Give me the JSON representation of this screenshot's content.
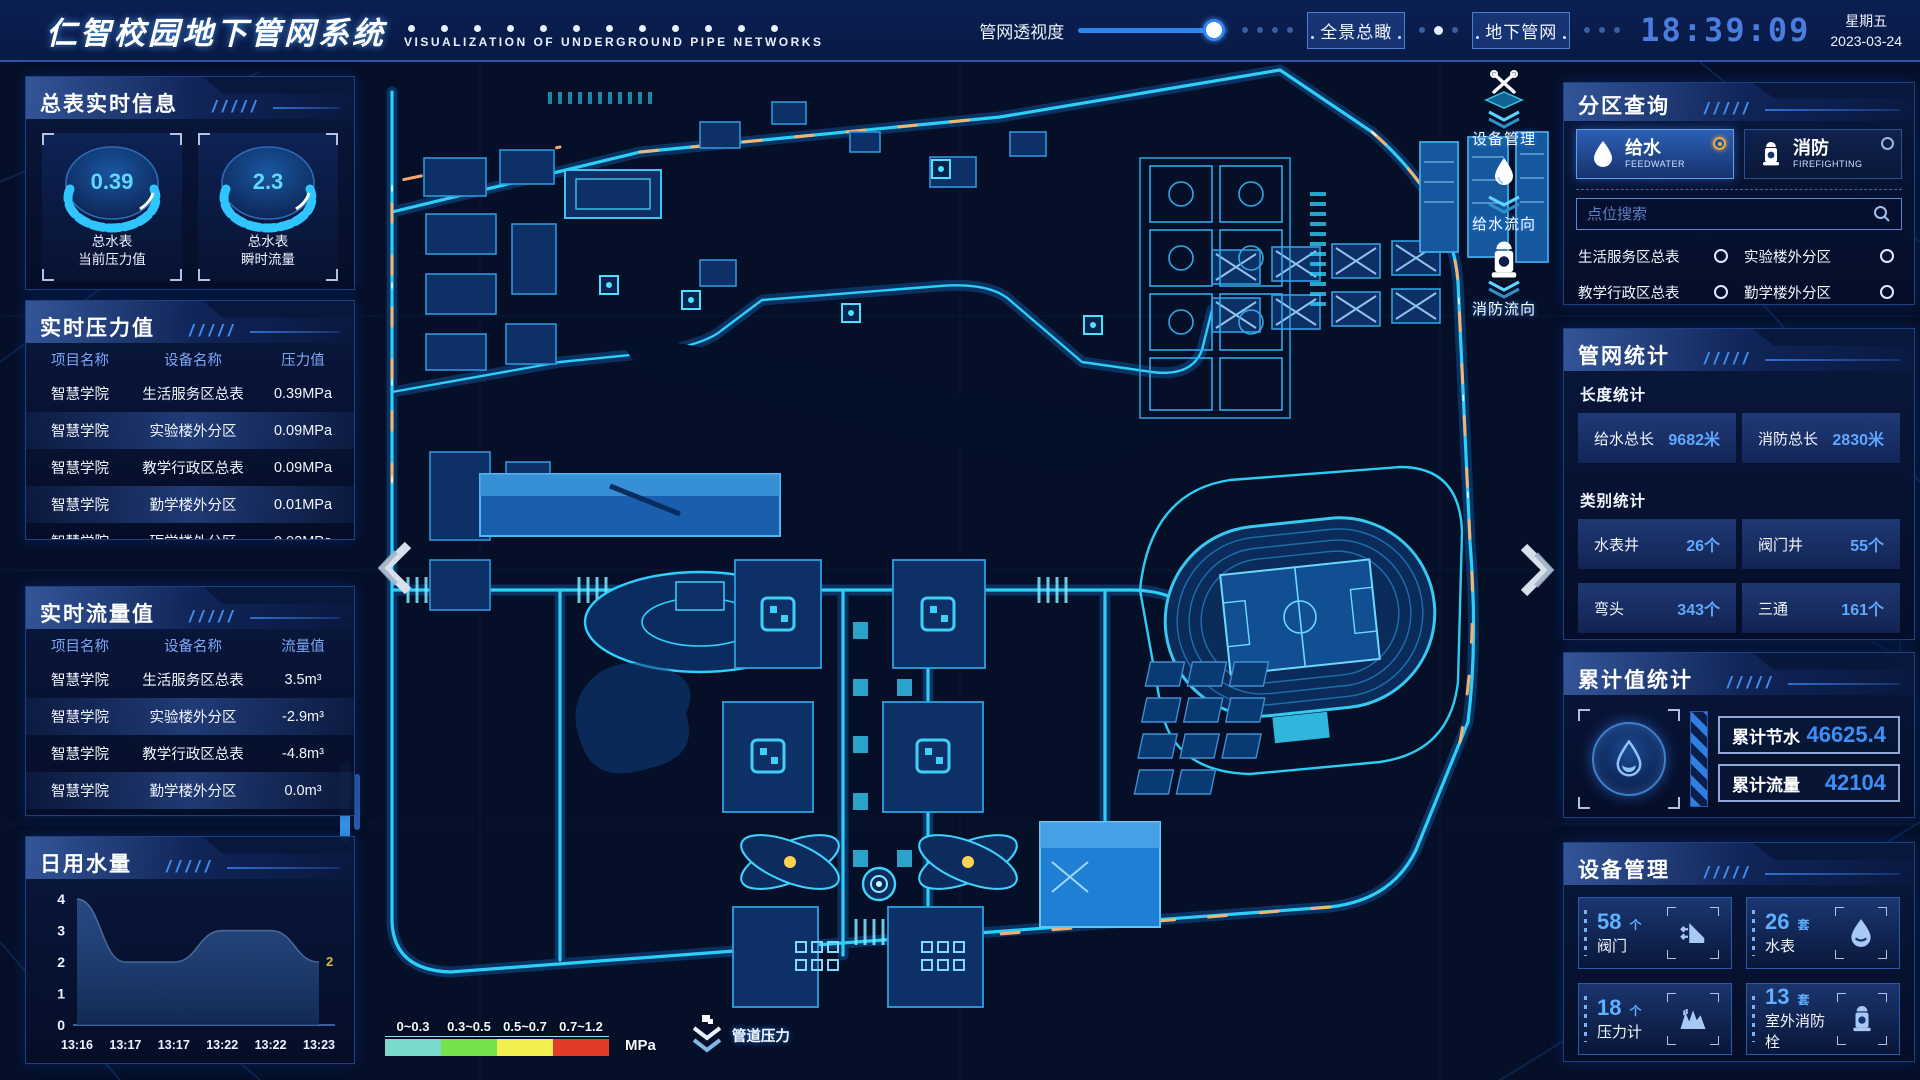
{
  "header": {
    "title": "仁智校园地下管网系统",
    "subtitle": "VISUALIZATION OF UNDERGROUND PIPE NETWORKS",
    "slider_label": "管网透视度",
    "btn_overview": "全景总瞰",
    "btn_underground": "地下管网",
    "time": "18:39:09",
    "weekday": "星期五",
    "date": "2023-03-24"
  },
  "left": {
    "meter": {
      "title": "总表实时信息",
      "gauges": [
        {
          "value": "0.39",
          "line1": "总水表",
          "line2": "当前压力值"
        },
        {
          "value": "2.3",
          "line1": "总水表",
          "line2": "瞬时流量"
        }
      ]
    },
    "pressure": {
      "title": "实时压力值",
      "headers": [
        "项目名称",
        "设备名称",
        "压力值"
      ],
      "rows": [
        [
          "智慧学院",
          "生活服务区总表",
          "0.39MPa"
        ],
        [
          "智慧学院",
          "实验楼外分区",
          "0.09MPa"
        ],
        [
          "智慧学院",
          "教学行政区总表",
          "0.09MPa"
        ],
        [
          "智慧学院",
          "勤学楼外分区",
          "0.01MPa"
        ],
        [
          "智慧学院",
          "砺学楼外分区",
          "0.02MPa"
        ]
      ]
    },
    "flow": {
      "title": "实时流量值",
      "headers": [
        "项目名称",
        "设备名称",
        "流量值"
      ],
      "rows": [
        [
          "智慧学院",
          "生活服务区总表",
          "3.5m³"
        ],
        [
          "智慧学院",
          "实验楼外分区",
          "-2.9m³"
        ],
        [
          "智慧学院",
          "教学行政区总表",
          "-4.8m³"
        ],
        [
          "智慧学院",
          "勤学楼外分区",
          "0.0m³"
        ],
        [
          "智慧学院",
          "砺学楼外分区",
          "2.3m³"
        ]
      ]
    },
    "daily": {
      "title": "日用水量"
    }
  },
  "chart_data": {
    "type": "area",
    "title": "日用水量",
    "x": [
      "13:16",
      "13:17",
      "13:17",
      "13:22",
      "13:22",
      "13:23"
    ],
    "values": [
      4,
      2,
      2,
      3,
      3,
      2
    ],
    "ylim": [
      0,
      4
    ],
    "yticks": [
      0,
      1,
      2,
      3,
      4
    ],
    "end_label": "2",
    "xlabel": "",
    "ylabel": "",
    "grid": false,
    "legend_position": "none"
  },
  "right": {
    "zone": {
      "title": "分区查询",
      "feedwater": {
        "label": "给水",
        "sub": "FEEDWATER",
        "selected": true
      },
      "fire": {
        "label": "消防",
        "sub": "FIREFIGHTING",
        "selected": false
      },
      "search_placeholder": "点位搜索",
      "zones": [
        "生活服务区总表",
        "实验楼外分区",
        "教学行政区总表",
        "勤学楼外分区",
        "砺学楼外分区",
        "宿舍区泵房"
      ]
    },
    "stats": {
      "title": "管网统计",
      "len_label": "长度统计",
      "cat_label": "类别统计",
      "length": [
        {
          "label": "给水总长",
          "value": "9682米"
        },
        {
          "label": "消防总长",
          "value": "2830米"
        }
      ],
      "categories": [
        {
          "label": "水表井",
          "value": "26个"
        },
        {
          "label": "阀门井",
          "value": "55个"
        },
        {
          "label": "弯头",
          "value": "343个"
        },
        {
          "label": "三通",
          "value": "161个"
        }
      ]
    },
    "cumulative": {
      "title": "累计值统计",
      "items": [
        {
          "label": "累计节水",
          "value": "46625.4"
        },
        {
          "label": "累计流量",
          "value": "42104"
        }
      ]
    },
    "devices": {
      "title": "设备管理",
      "items": [
        {
          "count": "58",
          "unit": "个",
          "label": "阀门",
          "icon": "valve-icon"
        },
        {
          "count": "26",
          "unit": "套",
          "label": "水表",
          "icon": "water-meter-icon"
        },
        {
          "count": "18",
          "unit": "个",
          "label": "压力计",
          "icon": "pressure-gauge-icon"
        },
        {
          "count": "13",
          "unit": "套",
          "label": "室外消防栓",
          "icon": "hydrant-icon"
        }
      ]
    }
  },
  "map": {
    "toolbar": [
      {
        "label": "设备管理",
        "icon": "wrench-icon"
      },
      {
        "label": "给水流向",
        "icon": "water-drop-icon"
      },
      {
        "label": "消防流向",
        "icon": "hydrant-icon"
      }
    ],
    "legend": {
      "ranges": [
        {
          "label": "0~0.3",
          "color": "#79d9cb"
        },
        {
          "label": "0.3~0.5",
          "color": "#74e24b"
        },
        {
          "label": "0.5~0.7",
          "color": "#f2ee4d"
        },
        {
          "label": "0.7~1.2",
          "color": "#e23c26"
        }
      ],
      "unit": "MPa",
      "pressure_label": "管道压力"
    },
    "accent_colors": {
      "road": "#2fd8ff",
      "flow": "#ffb36b"
    }
  }
}
